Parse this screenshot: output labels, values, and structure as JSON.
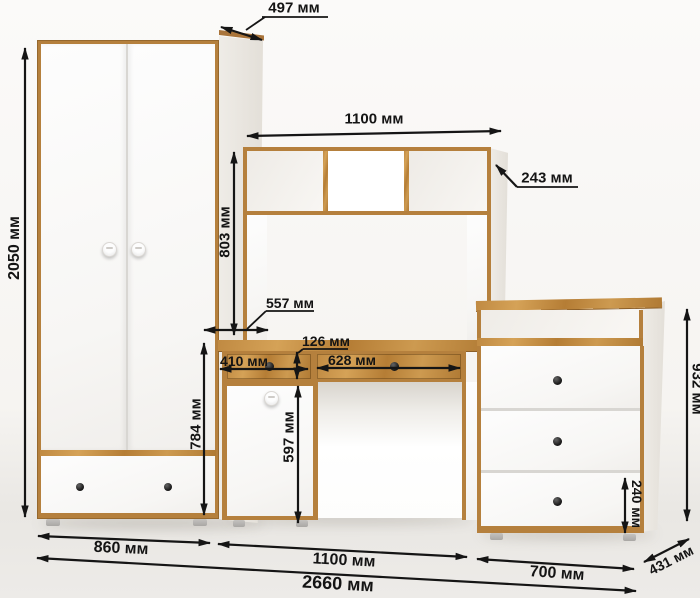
{
  "diagram": {
    "kind": "furniture dimension drawing",
    "units": "мм",
    "colors": {
      "wood": "#b5803d",
      "wood_light": "#d5a257",
      "panel_white": "#fbfbfb",
      "dimension_lines": "#151515",
      "background": "#f6f4f1"
    }
  },
  "dims": {
    "wardrobe_height": "2050 мм",
    "wardrobe_depth": "497 мм",
    "wardrobe_width": "860 мм",
    "hutch_width": "1100 мм",
    "hutch_depth": "243 мм",
    "hutch_height": "803 мм",
    "desk_depth": "557 мм",
    "desk_drawer_height": "126 мм",
    "desk_drawer_left_width": "410 мм",
    "desk_drawer_right_width": "628 мм",
    "desk_door_height": "597 мм",
    "desk_pedestal_height": "784 мм",
    "desk_width": "1100 мм",
    "chest_height": "932 мм",
    "chest_drawer_height": "240 мм",
    "chest_width": "700 мм",
    "chest_depth": "431 мм",
    "total_width": "2660 мм"
  }
}
